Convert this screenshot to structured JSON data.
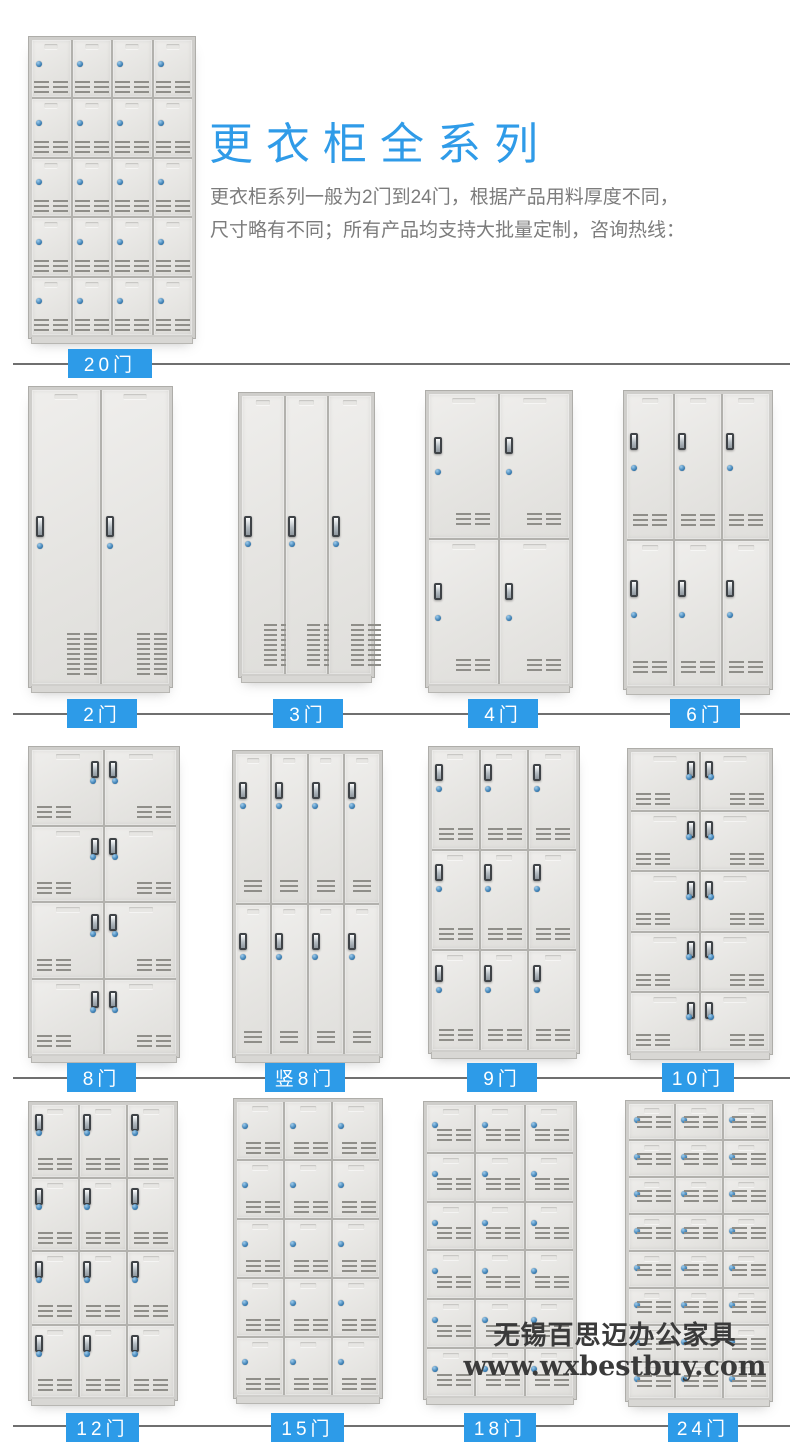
{
  "header": {
    "title": "更衣柜全系列",
    "description_line1": "更衣柜系列一般为2门到24门，根据产品用料厚度不同，",
    "description_line2": "尺寸略有不同；所有产品均支持大批量定制，咨询热线："
  },
  "watermark": {
    "line1": "无锡百思迈办公家具",
    "line2": "www.wxbestbuy.com"
  },
  "colors": {
    "accent_blue": "#2d9be8",
    "title_blue": "#2f9be8",
    "divider_gray": "#6f6f6f",
    "body_text_gray": "#7c7c7c",
    "door_gray": "#e6e5e2",
    "lock_blue": "#2f74ab",
    "watermark_gray": "#3a3a3a"
  },
  "dividers": [
    {
      "y": 363,
      "x1": 13,
      "x2": 790
    },
    {
      "y": 713,
      "x1": 13,
      "x2": 790
    },
    {
      "y": 1077,
      "x1": 13,
      "x2": 790
    },
    {
      "y": 1425,
      "x1": 13,
      "x2": 790
    }
  ],
  "lockers": [
    {
      "label": "20门",
      "key": "20men",
      "doors": 20,
      "cols": 4,
      "rows": 5,
      "style": "plain",
      "vent": "center2",
      "x": 28,
      "y": 36,
      "w": 168,
      "h": 303,
      "lbx": 68,
      "lby": 349,
      "lbw": 84
    },
    {
      "label": "2门",
      "key": "2men",
      "doors": 2,
      "cols": 2,
      "rows": 1,
      "style": "tall",
      "x": 28,
      "y": 386,
      "w": 145,
      "h": 302,
      "lbx": 67,
      "lby": 699,
      "lbw": 70
    },
    {
      "label": "3门",
      "key": "3men",
      "doors": 3,
      "cols": 3,
      "rows": 1,
      "style": "tall",
      "x": 238,
      "y": 392,
      "w": 137,
      "h": 286,
      "lbx": 273,
      "lby": 699,
      "lbw": 70
    },
    {
      "label": "4门",
      "key": "4men",
      "doors": 4,
      "cols": 2,
      "rows": 2,
      "style": "left",
      "handleTop": 30,
      "x": 425,
      "y": 390,
      "w": 148,
      "h": 298,
      "lbx": 468,
      "lby": 699,
      "lbw": 70
    },
    {
      "label": "6门",
      "key": "6men",
      "doors": 6,
      "cols": 3,
      "rows": 2,
      "style": "left",
      "handleTop": 27,
      "x": 623,
      "y": 390,
      "w": 150,
      "h": 300,
      "lbx": 670,
      "lby": 699,
      "lbw": 70
    },
    {
      "label": "8门",
      "key": "8men",
      "doors": 8,
      "cols": 2,
      "rows": 4,
      "style": "pair",
      "x": 28,
      "y": 746,
      "w": 152,
      "h": 312,
      "lbx": 67,
      "lby": 1063,
      "lbw": 69
    },
    {
      "label": "竖8门",
      "key": "shu8men",
      "doors": 8,
      "cols": 4,
      "rows": 2,
      "style": "half",
      "x": 232,
      "y": 750,
      "w": 151,
      "h": 308,
      "lbx": 265,
      "lby": 1063,
      "lbw": 80
    },
    {
      "label": "9门",
      "key": "9men",
      "doors": 9,
      "cols": 3,
      "rows": 3,
      "style": "left",
      "handleTop": 14,
      "x": 428,
      "y": 746,
      "w": 152,
      "h": 308,
      "lbx": 467,
      "lby": 1063,
      "lbw": 70
    },
    {
      "label": "10门",
      "key": "10men",
      "doors": 10,
      "cols": 2,
      "rows": 5,
      "style": "pair",
      "x": 627,
      "y": 748,
      "w": 146,
      "h": 307,
      "lbx": 662,
      "lby": 1063,
      "lbw": 72
    },
    {
      "label": "12门",
      "key": "12men",
      "doors": 12,
      "cols": 3,
      "rows": 4,
      "style": "left",
      "handleTop": 13,
      "x": 28,
      "y": 1101,
      "w": 150,
      "h": 300,
      "lbx": 66,
      "lby": 1413,
      "lbw": 73
    },
    {
      "label": "15门",
      "key": "15men",
      "doors": 15,
      "cols": 3,
      "rows": 5,
      "style": "plain",
      "vent": "center2b",
      "x": 233,
      "y": 1098,
      "w": 150,
      "h": 301,
      "lbx": 271,
      "lby": 1413,
      "lbw": 73
    },
    {
      "label": "18门",
      "key": "18men",
      "doors": 18,
      "cols": 3,
      "rows": 6,
      "style": "plain",
      "vent": "right2",
      "x": 423,
      "y": 1101,
      "w": 154,
      "h": 299,
      "lbx": 464,
      "lby": 1413,
      "lbw": 72
    },
    {
      "label": "24门",
      "key": "24men",
      "doors": 24,
      "cols": 3,
      "rows": 8,
      "style": "plain",
      "vent": "right2mid",
      "x": 625,
      "y": 1100,
      "w": 148,
      "h": 302,
      "lbx": 668,
      "lby": 1413,
      "lbw": 70
    }
  ]
}
